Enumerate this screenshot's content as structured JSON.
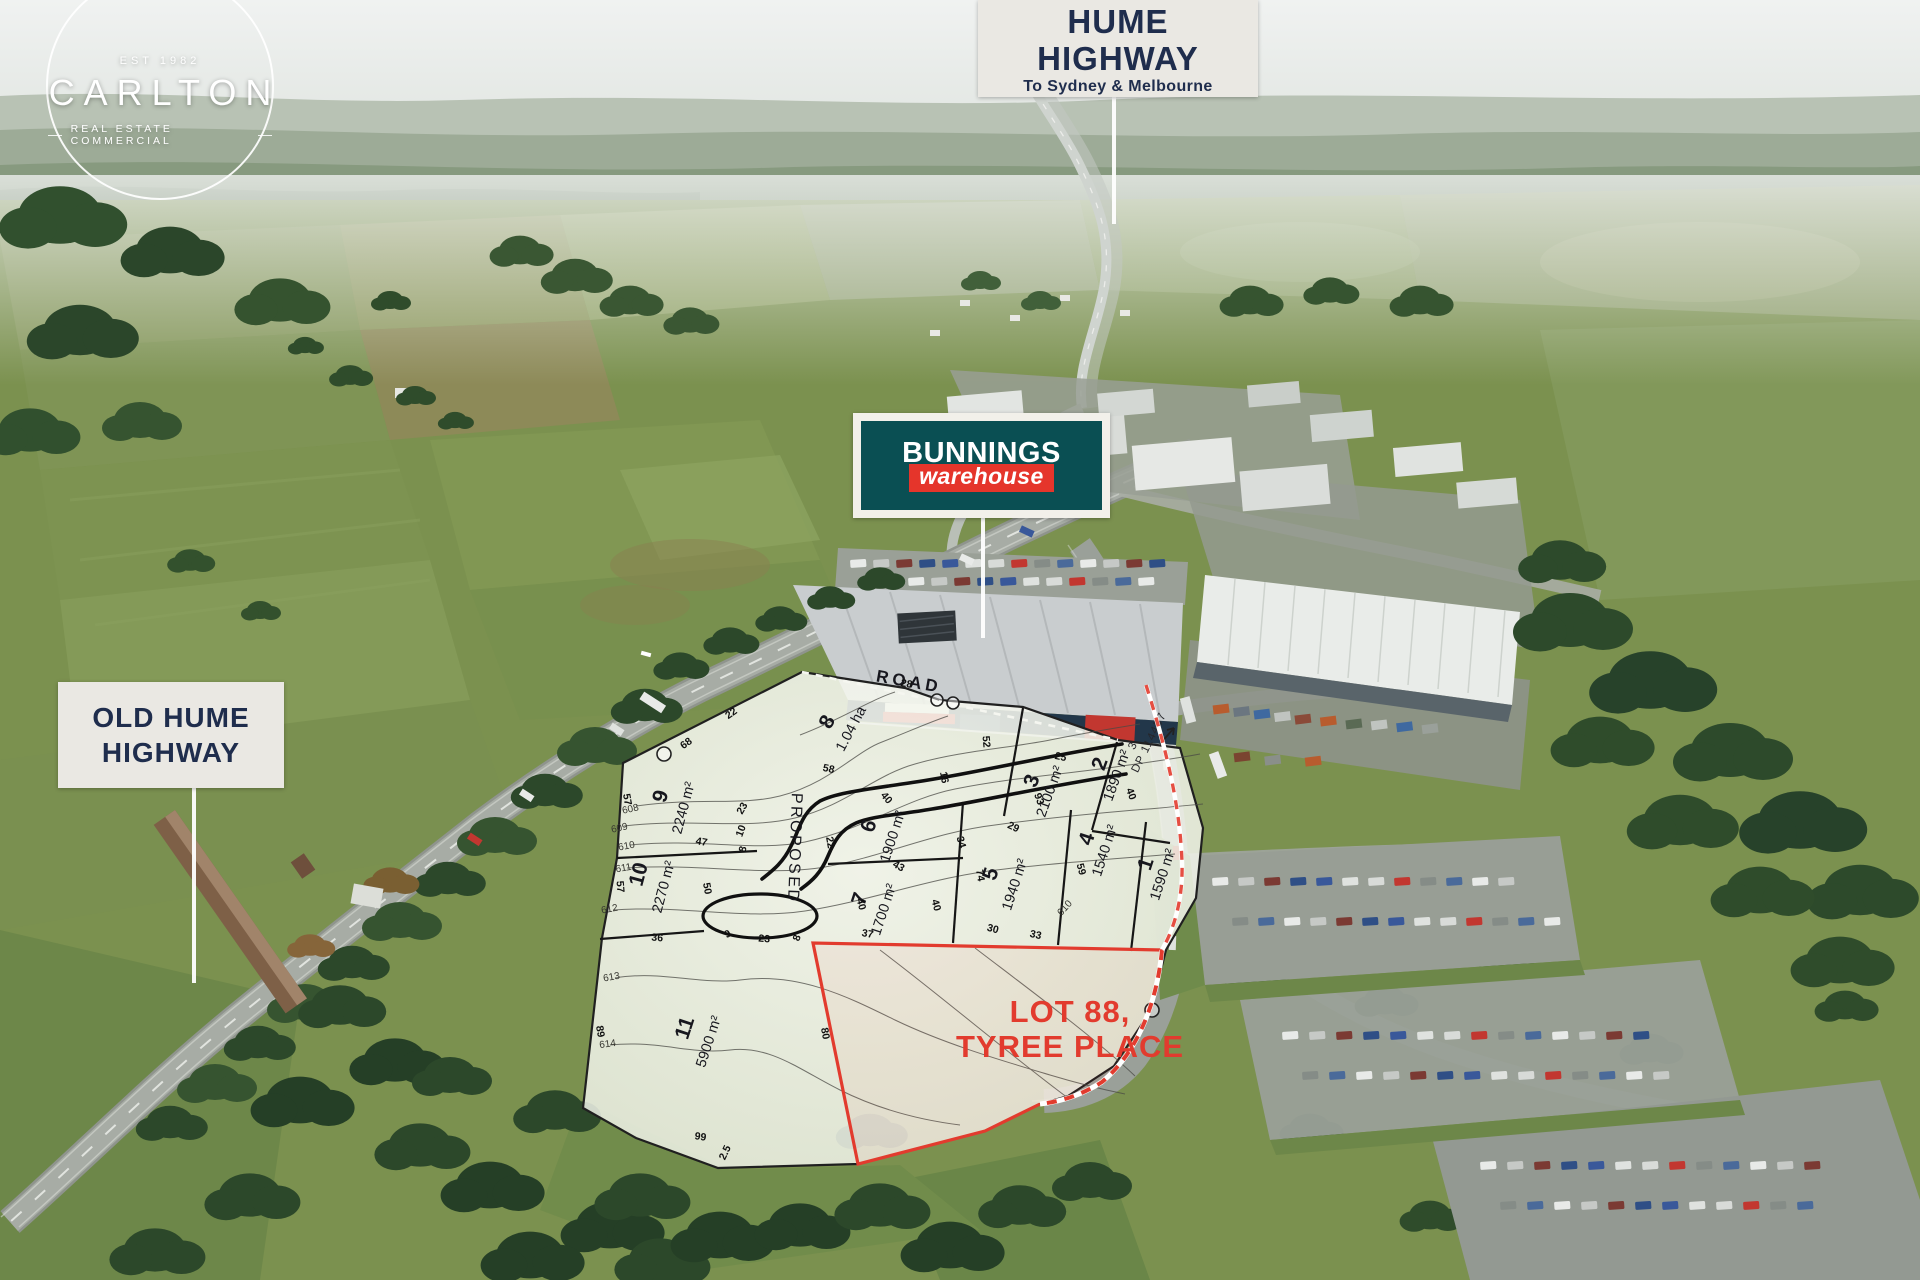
{
  "branding": {
    "est": "EST 1982",
    "name": "CARLTON",
    "tagline": "REAL ESTATE COMMERCIAL"
  },
  "callouts": {
    "hume_highway": {
      "line1": "HUME",
      "line2": "HIGHWAY",
      "subtitle": "To Sydney & Melbourne"
    },
    "old_hume_highway": {
      "line1": "OLD HUME",
      "line2": "HIGHWAY"
    },
    "bunnings": {
      "brand": "BUNNINGS",
      "sub": "warehouse"
    }
  },
  "plan": {
    "highlight": {
      "line1": "LOT 88,",
      "line2": "TYREE PLACE"
    },
    "road_labels": {
      "proposed": "PROPOSED",
      "road": "ROAD"
    },
    "adjacent_title": {
      "lot": "3",
      "plan_ref": "DP 114457"
    },
    "lots": [
      {
        "number": "1",
        "area": "1590 m²"
      },
      {
        "number": "2",
        "area": "1890 m²"
      },
      {
        "number": "3",
        "area": "2100 m²"
      },
      {
        "number": "4",
        "area": "1540 m²"
      },
      {
        "number": "5",
        "area": "1940 m²"
      },
      {
        "number": "6",
        "area": "1900 m²"
      },
      {
        "number": "7",
        "area": "1700 m²"
      },
      {
        "number": "8",
        "area": "1.04 ha"
      },
      {
        "number": "9",
        "area": "2240 m²"
      },
      {
        "number": "10",
        "area": "2270 m²"
      },
      {
        "number": "11",
        "area": "5900 m²"
      }
    ],
    "dimensions": [
      {
        "t": "22"
      },
      {
        "t": "68"
      },
      {
        "t": "28"
      },
      {
        "t": "58"
      },
      {
        "t": "16"
      },
      {
        "t": "52"
      },
      {
        "t": "25"
      },
      {
        "t": "29"
      },
      {
        "t": "34"
      },
      {
        "t": "74"
      },
      {
        "t": "40"
      },
      {
        "t": "22"
      },
      {
        "t": "43"
      },
      {
        "t": "40"
      },
      {
        "t": "37"
      },
      {
        "t": "40"
      },
      {
        "t": "30"
      },
      {
        "t": "59"
      },
      {
        "t": "23"
      },
      {
        "t": "10"
      },
      {
        "t": "8"
      },
      {
        "t": "47"
      },
      {
        "t": "50"
      },
      {
        "t": "57"
      },
      {
        "t": "57"
      },
      {
        "t": "36"
      },
      {
        "t": "9"
      },
      {
        "t": "23"
      },
      {
        "t": "8"
      },
      {
        "t": "80"
      },
      {
        "t": "89"
      },
      {
        "t": "99"
      },
      {
        "t": "2.5"
      },
      {
        "t": "40"
      },
      {
        "t": "33"
      },
      {
        "t": "93"
      }
    ],
    "contours": [
      {
        "t": "608"
      },
      {
        "t": "609"
      },
      {
        "t": "610"
      },
      {
        "t": "611"
      },
      {
        "t": "612"
      },
      {
        "t": "613"
      },
      {
        "t": "614"
      },
      {
        "t": "610"
      }
    ]
  },
  "colors": {
    "accent_red": "#e23b2e",
    "bunnings_green": "#0a4f53",
    "bunnings_red": "#e5352b",
    "label_navy": "#1f2d4d",
    "label_bg": "#eae8e3"
  }
}
